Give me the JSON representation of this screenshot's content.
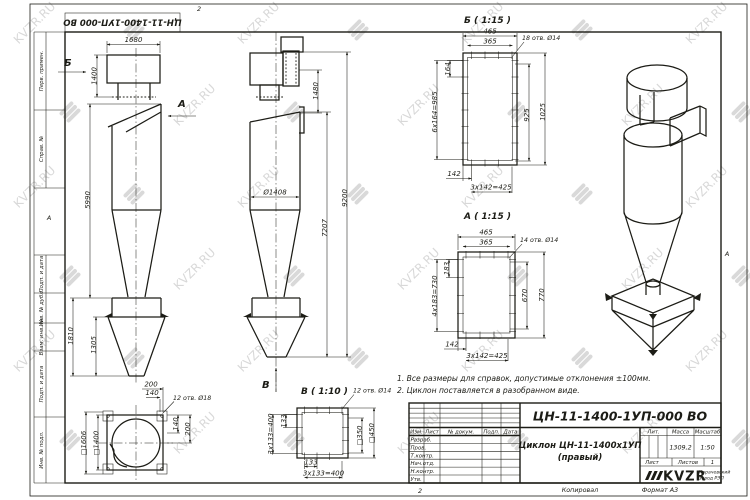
{
  "sheet": {
    "doc_number": "ЦН-11-1400-1УП-000 ВО",
    "zone_top": "2",
    "zone_bottom": "2",
    "zone_left": "А",
    "zone_right": "А",
    "copied": "Копировал",
    "format": "Формат А3"
  },
  "stamps": {
    "perv_primen": "Перв. примен.",
    "sprav_no": "Справ. №",
    "podp_data_1": "Подп. и дата",
    "inv_dubl": "Инв. № дубл.",
    "vzam_inv": "Взам. инв. №",
    "podp_data_2": "Подп. и дата",
    "inv_podl": "Инв. № подл."
  },
  "watermark": {
    "text": "KVZR.RU"
  },
  "notes": {
    "line1": "1. Все размеры для справок, допустимые отклонения ±100мм.",
    "line2": "2. Циклон поставляется в разобранном виде."
  },
  "views": {
    "side": {
      "arrow_b": "Б",
      "arrow_a": "А",
      "dim_1680": "1680",
      "dim_1400": "1400",
      "dim_5990": "5990",
      "dim_1810": "1810",
      "dim_1305": "1305"
    },
    "front": {
      "arrow_v": "В",
      "dim_1480": "1480",
      "dim_9200": "9200",
      "dim_7207": "7207",
      "dim_dia": "Ø1408"
    },
    "detail_b": {
      "title": "Б ( 1:15 )",
      "holes": "18 отв. Ø14",
      "dim_465": "465",
      "dim_365": "365",
      "dim_164": "164",
      "dim_985": "6х164=985",
      "dim_925": "925",
      "dim_1025": "1025",
      "dim_142": "142",
      "dim_425": "3х142=425"
    },
    "detail_a": {
      "title": "А ( 1:15 )",
      "holes": "14 отв. Ø14",
      "dim_465": "465",
      "dim_365": "365",
      "dim_183": "183",
      "dim_730": "4х183=730",
      "dim_670": "670",
      "dim_770": "770",
      "dim_142": "142",
      "dim_425": "3х142=425"
    },
    "detail_v": {
      "title": "В ( 1:10 )",
      "holes": "12 отв. Ø14",
      "dim_133_l": "133",
      "dim_400_l": "3х133=400",
      "dim_350": "□350",
      "dim_450": "□450",
      "dim_133_b": "133",
      "dim_400_b": "3х133=400"
    },
    "plan": {
      "holes": "12 отв. Ø18",
      "dim_200_t": "200",
      "dim_140_t": "140",
      "dim_1606": "□1606",
      "dim_1400": "□1400",
      "dim_140_r": "140",
      "dim_200_r": "200"
    }
  },
  "title_block": {
    "doc_number": "ЦН-11-1400-1УП-000 ВО",
    "name_line1": "Циклон ЦН-11-1400х1УП",
    "name_line2": "(правый)",
    "col_izm": "Изм.",
    "col_list": "Лист",
    "col_doc": "№ докум.",
    "col_podp": "Подп.",
    "col_data": "Дата",
    "row_razrab": "Разраб.",
    "row_prov": "Пров.",
    "row_tkontr": "Т.контр.",
    "row_nachotd": "Нач.отд.",
    "row_nkontr": "Н.контр.",
    "row_utv": "Утв.",
    "lit": "Лит.",
    "mass": "Масса",
    "scale": "Масштаб",
    "mass_value": "1309,2",
    "scale_value": "1:50",
    "sheet": "Лист",
    "sheets": "Листов",
    "sheets_value": "1",
    "logo": "KVZR",
    "company1": "Карачевский",
    "company2": "завод РЭП"
  }
}
